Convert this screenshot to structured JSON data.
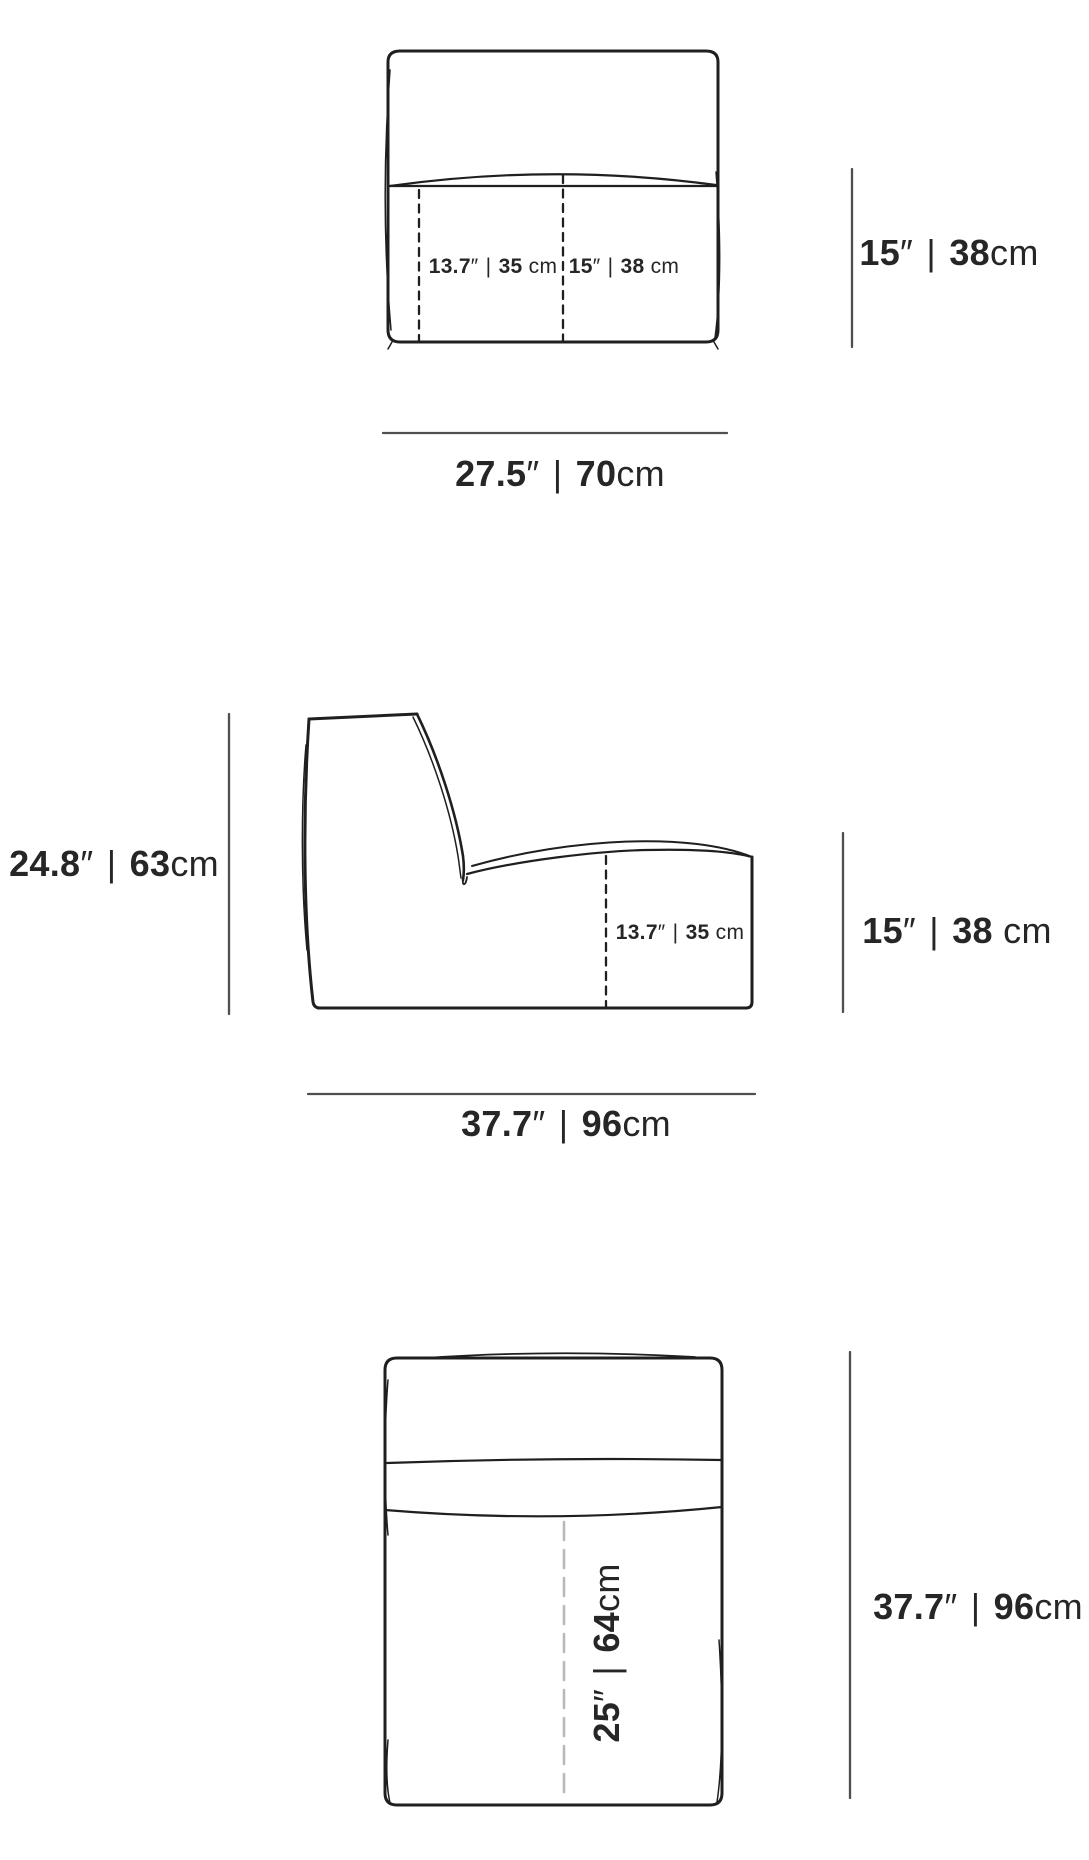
{
  "views": {
    "front": {
      "seat_split_left": {
        "in": "13.7",
        "mark": "″",
        "sep": " | ",
        "cm": "35",
        "unit": " cm"
      },
      "seat_split_right": {
        "in": "15",
        "mark": "″",
        "sep": " | ",
        "cm": "38",
        "unit": " cm"
      },
      "seat_height": {
        "in": "15",
        "mark": "″",
        "sep": " | ",
        "cm": "38",
        "unit": "cm"
      },
      "width": {
        "in": "27.5",
        "mark": "″",
        "sep": " | ",
        "cm": "70",
        "unit": "cm"
      }
    },
    "side": {
      "height": {
        "in": "24.8",
        "mark": "″",
        "sep": " | ",
        "cm": "63",
        "unit": "cm"
      },
      "seat_depth": {
        "in": "13.7",
        "mark": "″",
        "sep": " | ",
        "cm": "35",
        "unit": " cm"
      },
      "seat_height": {
        "in": "15",
        "mark": "″",
        "sep": " | ",
        "cm": "38",
        "unit": " cm"
      },
      "depth": {
        "in": "37.7",
        "mark": "″",
        "sep": " | ",
        "cm": "96",
        "unit": "cm"
      }
    },
    "top": {
      "seat_width": {
        "in": "25",
        "mark": "″",
        "sep": " | ",
        "cm": "64",
        "unit": "cm"
      },
      "depth": {
        "in": "37.7",
        "mark": "″",
        "sep": " | ",
        "cm": "96",
        "unit": "cm"
      }
    }
  },
  "colors": {
    "line": "#1f1f1f",
    "dimension_line": "#4f4f4f",
    "dashed_line": "#1f1f1f",
    "dashed_line_light": "#b9b9b9",
    "text": "#262626",
    "background": "#ffffff"
  }
}
